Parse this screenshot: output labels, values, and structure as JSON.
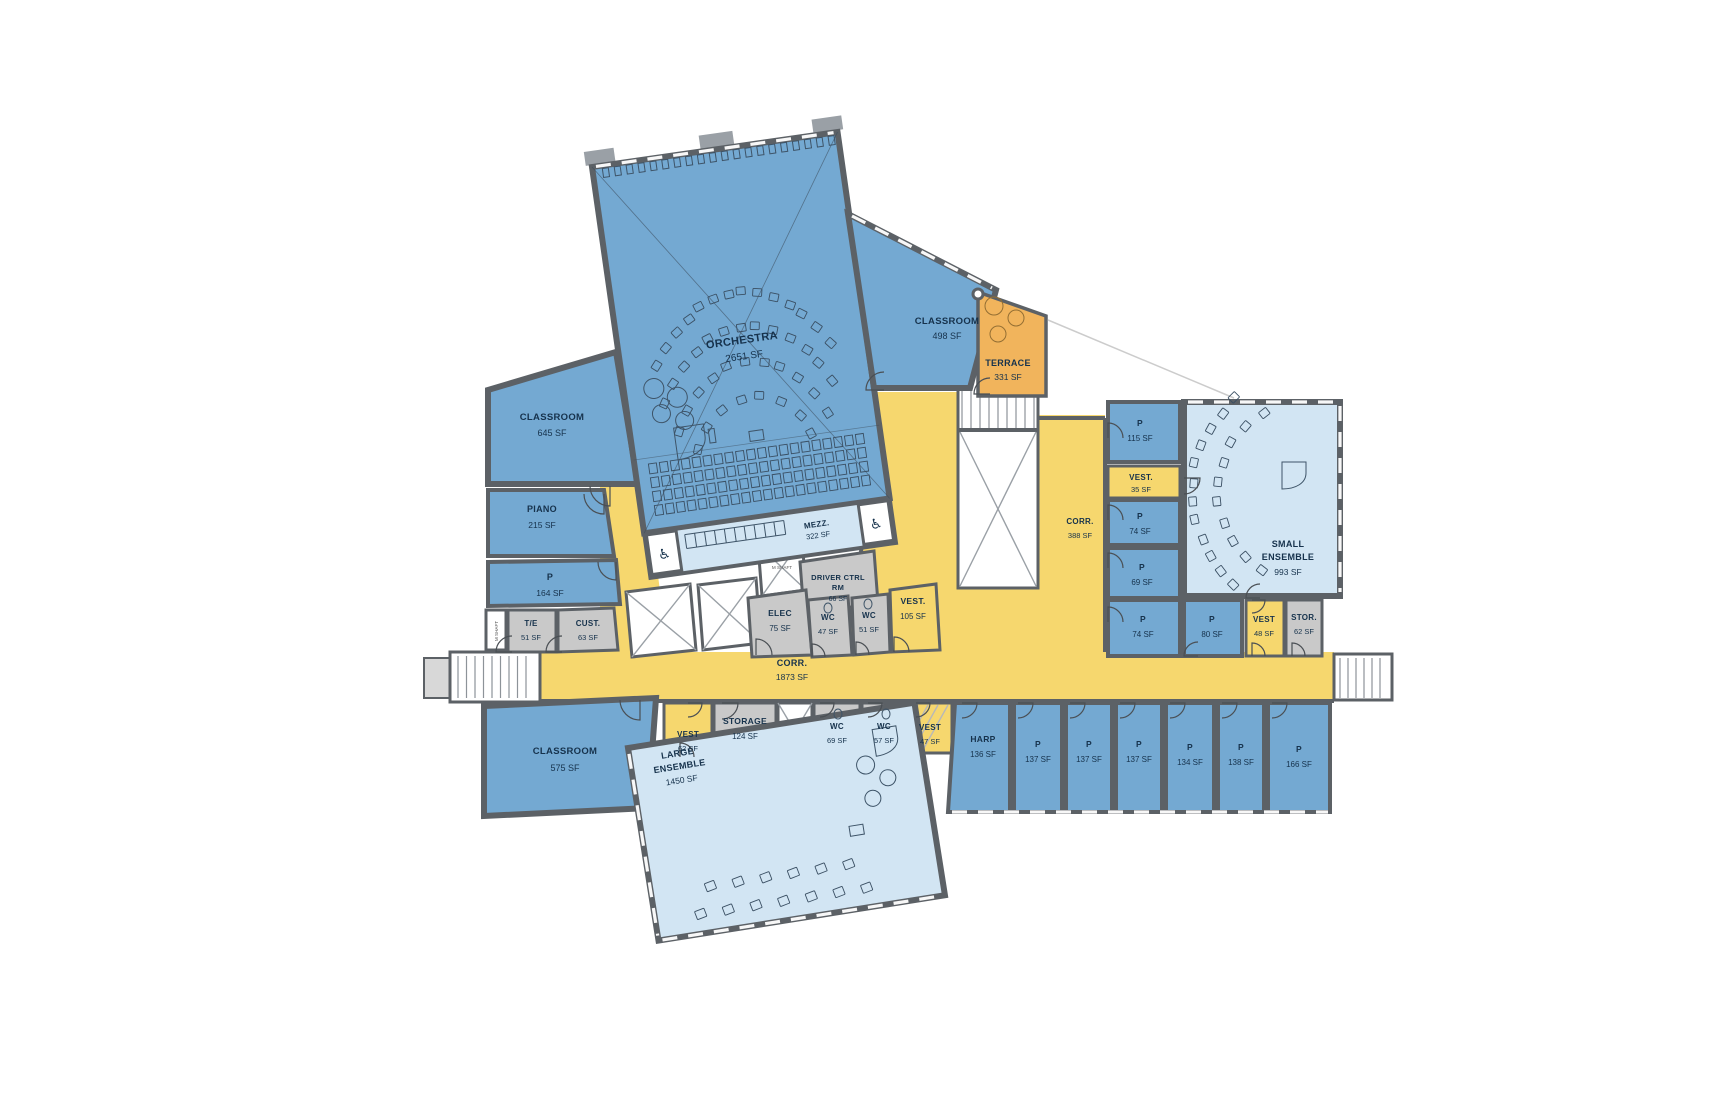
{
  "plan": {
    "colors": {
      "room_blue": "#74a9d2",
      "room_lightblue": "#d2e5f3",
      "circulation_yellow": "#f6d76e",
      "terrace_orange": "#f1b45c",
      "service_gray": "#c9c9c9",
      "wall": "#5c6166",
      "text_color": "#16324c"
    },
    "labels": {
      "shaft": "M SHAFT"
    },
    "rooms": {
      "orchestra": {
        "name": "ORCHESTRA",
        "area": "2651 SF"
      },
      "mezz": {
        "name": "MEZZ.",
        "area": "322 SF"
      },
      "classroom_498": {
        "name": "CLASSROOM",
        "area": "498 SF"
      },
      "terrace": {
        "name": "TERRACE",
        "area": "331 SF"
      },
      "classroom_645": {
        "name": "CLASSROOM",
        "area": "645 SF"
      },
      "piano": {
        "name": "PIANO",
        "area": "215 SF"
      },
      "p_164": {
        "name": "P",
        "area": "164 SF"
      },
      "te": {
        "name": "T/E",
        "area": "51 SF"
      },
      "cust": {
        "name": "CUST.",
        "area": "63 SF"
      },
      "driver_ctrl": {
        "name1": "DRIVER CTRL",
        "name2": "RM",
        "area": "66 SF"
      },
      "elec": {
        "name": "ELEC",
        "area": "75 SF"
      },
      "wc_47": {
        "name": "WC",
        "area": "47 SF"
      },
      "wc_51": {
        "name": "WC",
        "area": "51 SF"
      },
      "vest_105": {
        "name": "VEST.",
        "area": "105 SF"
      },
      "corr_main": {
        "name": "CORR.",
        "area": "1873 SF"
      },
      "corr_388": {
        "name": "CORR.",
        "area": "388 SF"
      },
      "p_115": {
        "name": "P",
        "area": "115 SF"
      },
      "vest_35": {
        "name": "VEST.",
        "area": "35 SF"
      },
      "p_74a": {
        "name": "P",
        "area": "74 SF"
      },
      "p_69": {
        "name": "P",
        "area": "69 SF"
      },
      "p_74b": {
        "name": "P",
        "area": "74 SF"
      },
      "p_80": {
        "name": "P",
        "area": "80 SF"
      },
      "small_ensemble": {
        "name1": "SMALL",
        "name2": "ENSEMBLE",
        "area": "993 SF"
      },
      "vest_48": {
        "name": "VEST",
        "area": "48 SF"
      },
      "stor_62": {
        "name": "STOR.",
        "area": "62 SF"
      },
      "classroom_575": {
        "name": "CLASSROOM",
        "area": "575 SF"
      },
      "vest_62": {
        "name": "VEST",
        "area": "62 SF"
      },
      "storage_124": {
        "name": "STORAGE",
        "area": "124 SF"
      },
      "wc_69": {
        "name": "WC",
        "area": "69 SF"
      },
      "wc_57": {
        "name": "WC",
        "area": "57 SF"
      },
      "vest_47": {
        "name": "VEST",
        "area": "47 SF"
      },
      "large_ensemble": {
        "name1": "LARGE",
        "name2": "ENSEMBLE",
        "area": "1450 SF"
      },
      "harp": {
        "name": "HARP",
        "area": "136 SF"
      },
      "p_137a": {
        "name": "P",
        "area": "137 SF"
      },
      "p_137b": {
        "name": "P",
        "area": "137 SF"
      },
      "p_137c": {
        "name": "P",
        "area": "137 SF"
      },
      "p_134": {
        "name": "P",
        "area": "134 SF"
      },
      "p_138": {
        "name": "P",
        "area": "138 SF"
      },
      "p_166": {
        "name": "P",
        "area": "166 SF"
      }
    }
  }
}
